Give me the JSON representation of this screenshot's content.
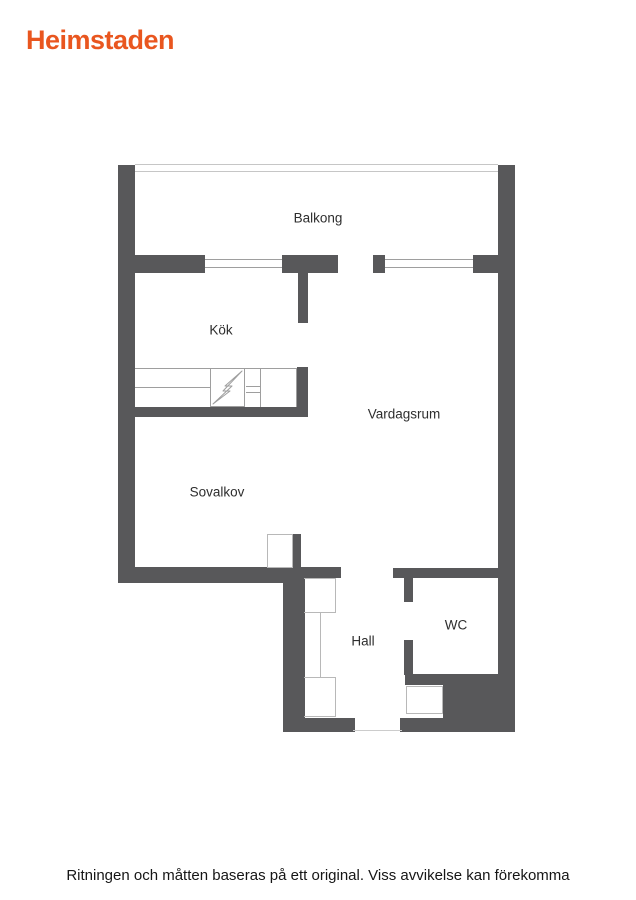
{
  "brand": {
    "logo_text": "Heimstaden"
  },
  "theme": {
    "brand_color": "#E9561F",
    "wall_color": "#58585A",
    "line_color": "#9E9E9E",
    "light_line_color": "#C6C6C6",
    "label_color": "#2E2E2E"
  },
  "floorplan": {
    "rooms": [
      {
        "id": "balkong",
        "label": "Balkong"
      },
      {
        "id": "kok",
        "label": "Kök"
      },
      {
        "id": "vardagsrum",
        "label": "Vardagsrum"
      },
      {
        "id": "sovalkov",
        "label": "Sovalkov"
      },
      {
        "id": "hall",
        "label": "Hall"
      },
      {
        "id": "wc",
        "label": "WC"
      }
    ],
    "stove_icon": "lightning-bolt-icon"
  },
  "footer": {
    "disclaimer": "Ritningen och måtten baseras på ett original. Viss avvikelse kan förekomma"
  }
}
